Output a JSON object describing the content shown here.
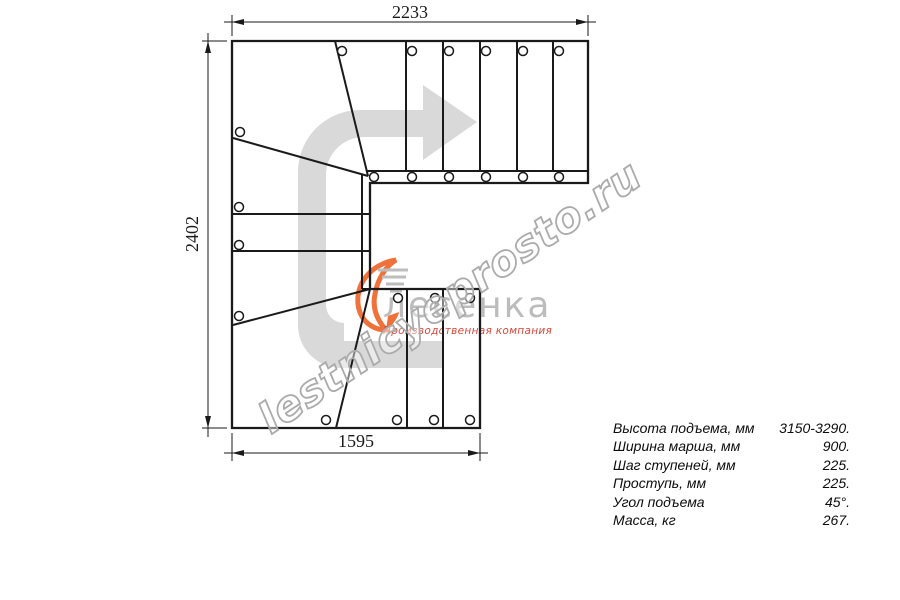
{
  "page": {
    "background": "#ffffff",
    "type": "staircase-plan-drawing"
  },
  "drawing": {
    "dims": {
      "top": "2233",
      "left": "2402",
      "bottom": "1595"
    },
    "arrow_icon": "direction-arrow-icon",
    "arrow_color": "#d9d9d9",
    "line_color": "#1a1a1a"
  },
  "logo": {
    "icon": "swoosh-flame-icon",
    "icon_color": "#f0713a",
    "name": "лесенка",
    "name_color": "#bcbcbc",
    "tagline": "Производственная компания",
    "tagline_color": "#d6493a"
  },
  "watermark": {
    "text": "lestnicyeprosto.ru",
    "color": "#ababab"
  },
  "specs": {
    "rows": [
      {
        "label": "Высота подъема, мм",
        "value": "3150-3290."
      },
      {
        "label": "Ширина марша, мм",
        "value": "900."
      },
      {
        "label": "Шаг ступеней, мм",
        "value": "225."
      },
      {
        "label": "Проступь, мм",
        "value": "225."
      },
      {
        "label": "Угол подъема",
        "value": "45°."
      },
      {
        "label": "Масса, кг",
        "value": "267."
      }
    ]
  }
}
